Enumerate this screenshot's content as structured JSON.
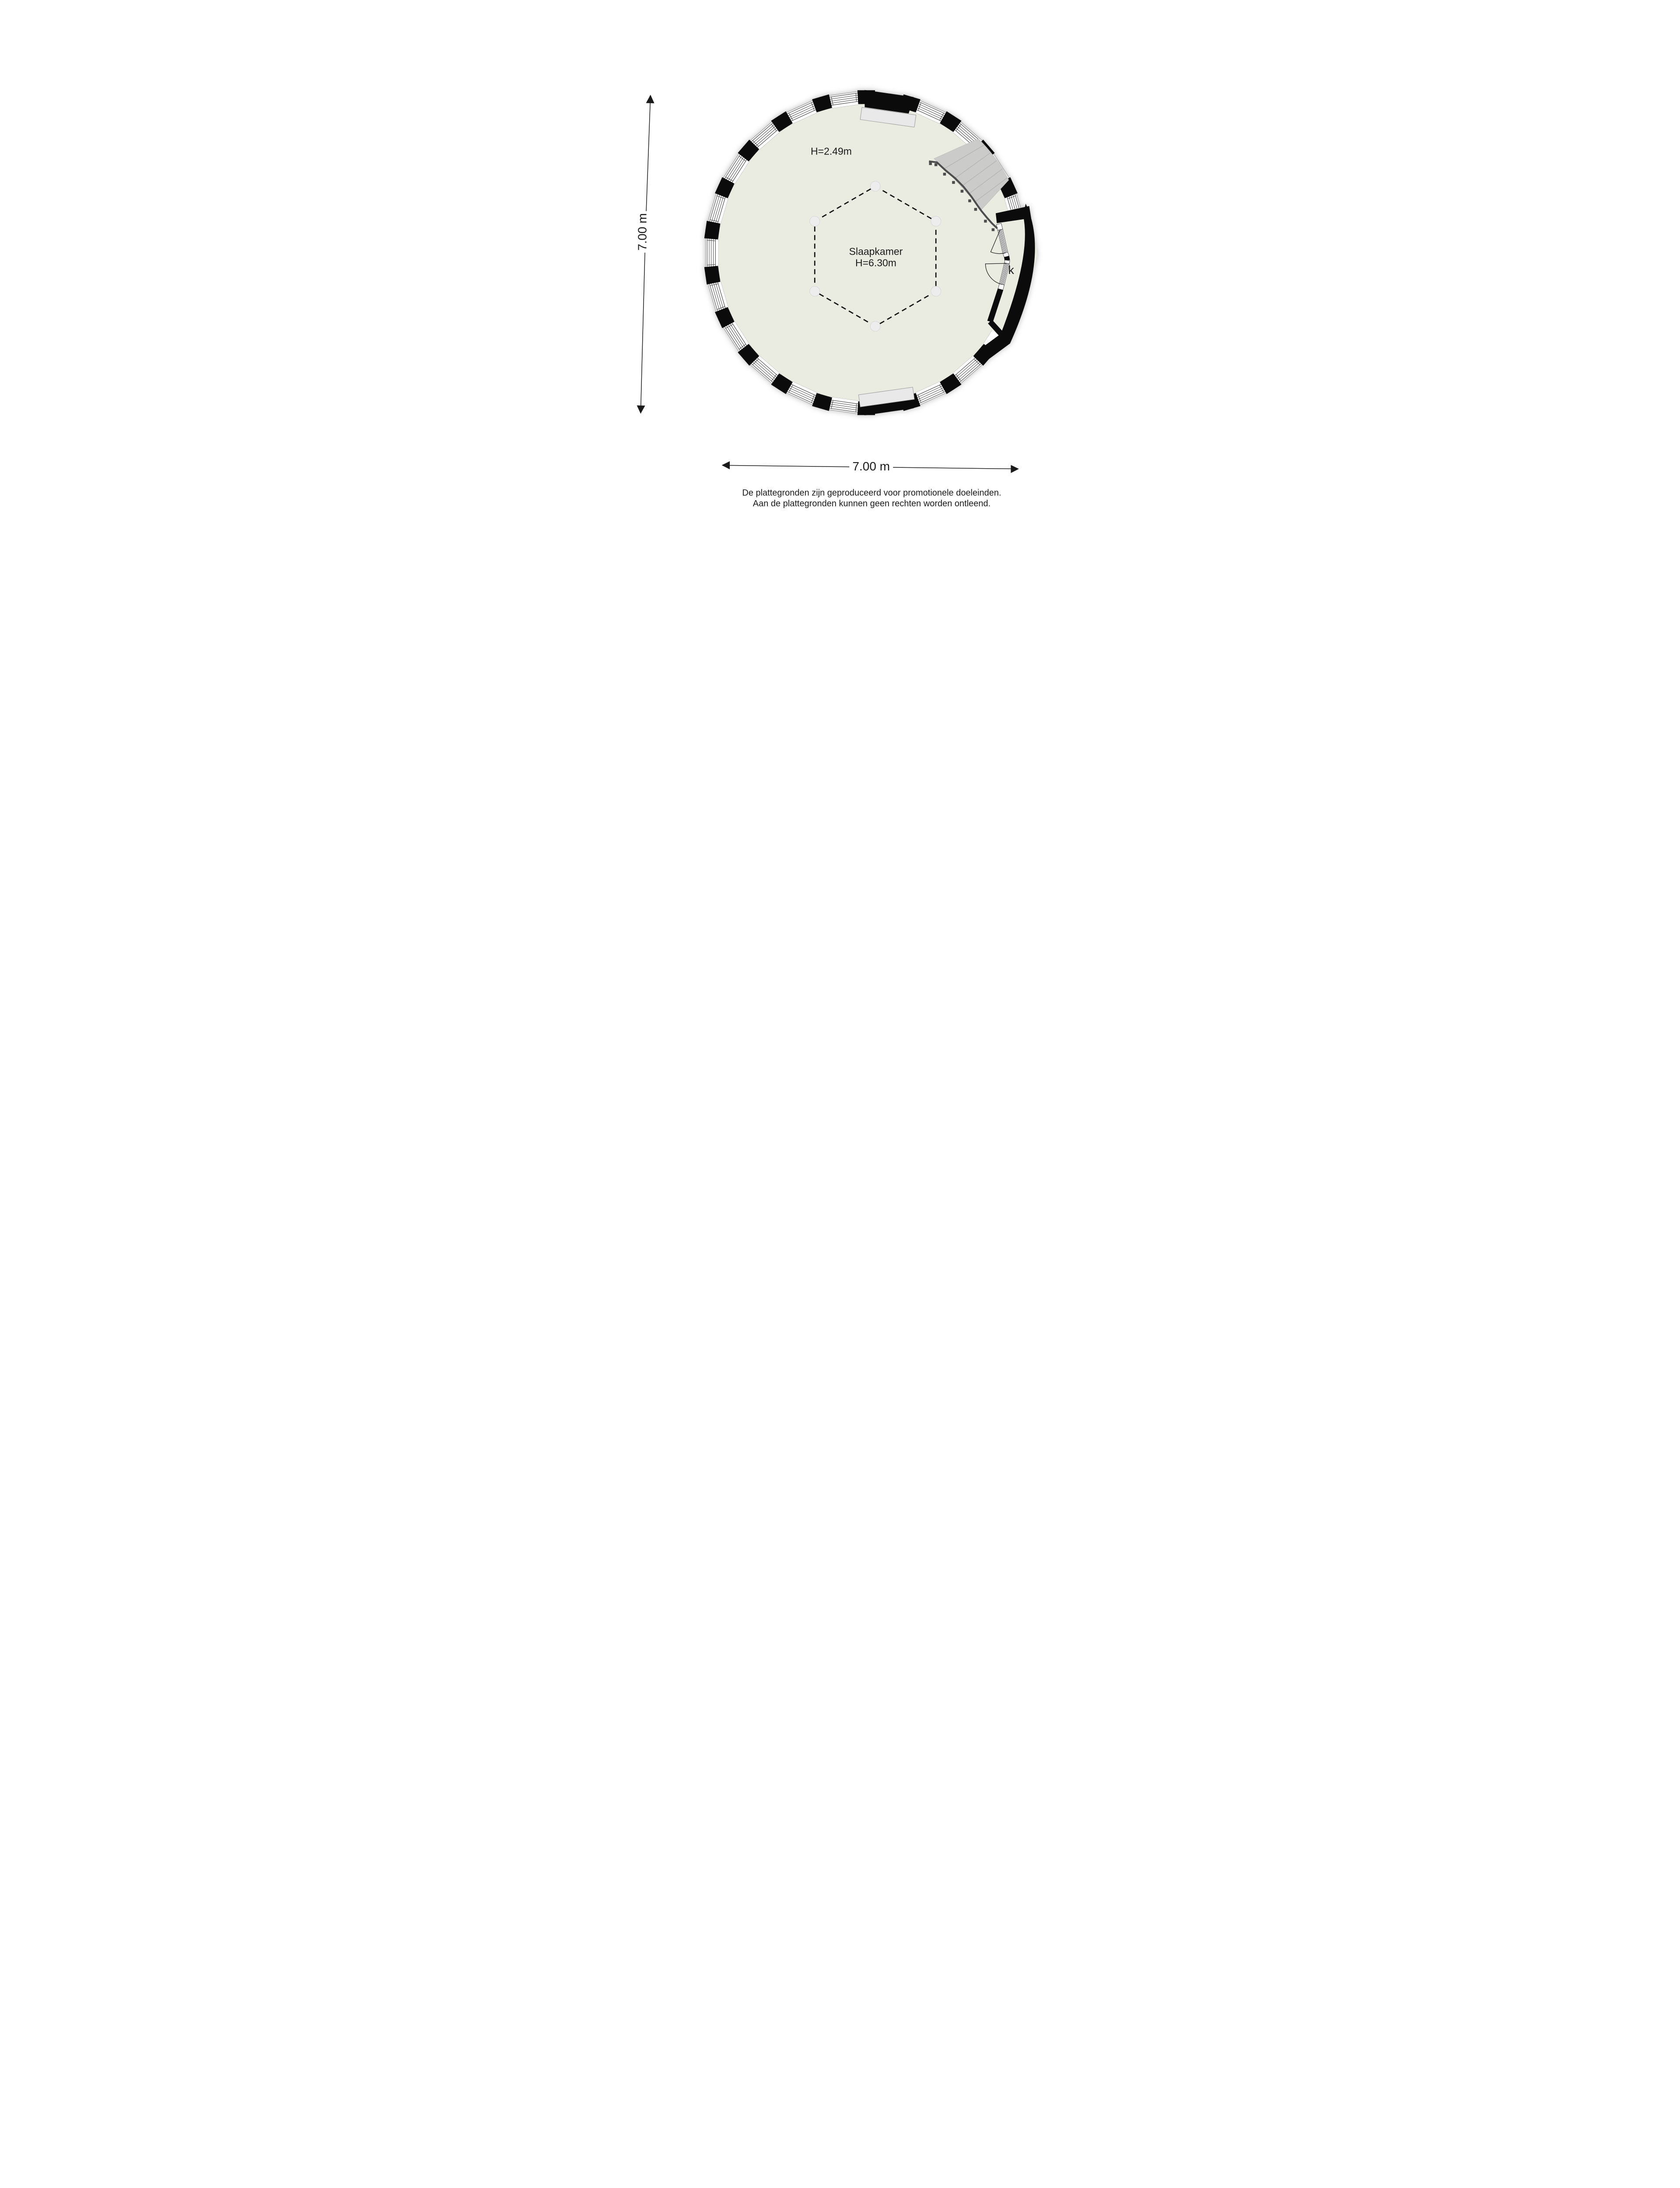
{
  "plan": {
    "ceiling_height_label": "H=2.49m",
    "room_name": "Slaapkamer",
    "room_height_label": "H=6.30m",
    "closet_label": "k",
    "colors": {
      "floor": "#EAEBE1",
      "wall": "#0B0B0B",
      "band_fill": "#FFFFFF",
      "band_outline": "#8F8F8F",
      "window_frame": "#2E2E2E",
      "stairs": "#CBCBCA",
      "stairs_edge": "#B8B8B8",
      "stair_treads": "#B5B5B5",
      "railing": "#4D4D4D",
      "radiator": "#E9E9E9",
      "radiator_border": "#9A9A9A",
      "grid_dash": "#141414",
      "grid_circle": "#EDEDED",
      "grid_circle_border": "#D6D6D6",
      "dimension_line": "#1A1A1A",
      "text": "#1B1B1B"
    }
  },
  "dimensions": {
    "width_label": "7.00 m",
    "height_label": "7.00 m"
  },
  "disclaimer": {
    "line1": "De plattegronden zijn geproduceerd voor promotionele doeleinden.",
    "line2": "Aan de plattegronden kunnen geen rechten worden ontleend."
  }
}
